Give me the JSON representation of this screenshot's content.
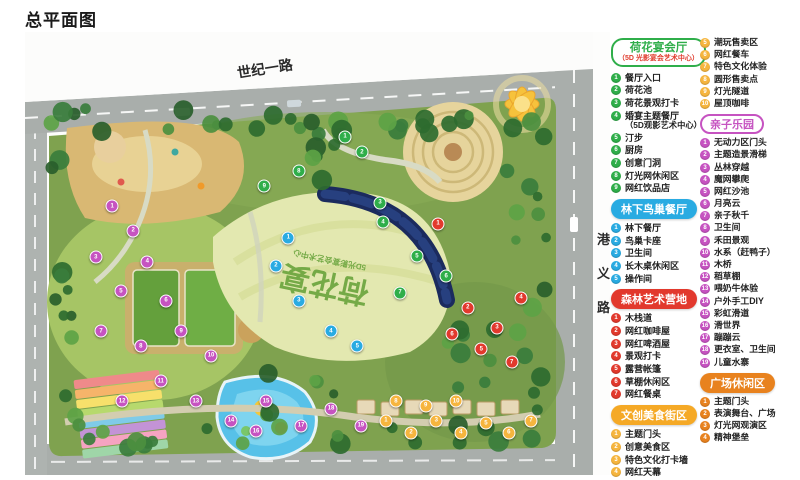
{
  "page": {
    "title": "总平面图"
  },
  "map": {
    "road_top_label": "世纪一路",
    "road_right_label": "港义路",
    "lawn_title": "荷花宴",
    "lawn_subtitle": "5D光影宴会艺术中心",
    "marker_colors": {
      "green": "#2fae4a",
      "blue": "#29abe2",
      "red": "#e2392d",
      "magenta": "#c653c1",
      "yellow": "#f6b53e"
    },
    "markers": [
      {
        "n": 1,
        "c": "green",
        "x": 54.7,
        "y": 23.7
      },
      {
        "n": 2,
        "c": "green",
        "x": 57.6,
        "y": 27.1
      },
      {
        "n": 3,
        "c": "green",
        "x": 60.7,
        "y": 38.6
      },
      {
        "n": 4,
        "c": "green",
        "x": 61.2,
        "y": 42.9
      },
      {
        "n": 5,
        "c": "green",
        "x": 67.0,
        "y": 50.6
      },
      {
        "n": 6,
        "c": "green",
        "x": 72.0,
        "y": 55.1
      },
      {
        "n": 7,
        "c": "green",
        "x": 64.1,
        "y": 58.9
      },
      {
        "n": 8,
        "c": "green",
        "x": 46.8,
        "y": 31.4
      },
      {
        "n": 9,
        "c": "green",
        "x": 40.9,
        "y": 34.8
      },
      {
        "n": 1,
        "c": "blue",
        "x": 45.0,
        "y": 46.5
      },
      {
        "n": 2,
        "c": "blue",
        "x": 42.9,
        "y": 52.8
      },
      {
        "n": 3,
        "c": "blue",
        "x": 46.8,
        "y": 60.7
      },
      {
        "n": 4,
        "c": "blue",
        "x": 52.3,
        "y": 67.5
      },
      {
        "n": 5,
        "c": "blue",
        "x": 56.8,
        "y": 70.9
      },
      {
        "n": 1,
        "c": "red",
        "x": 70.6,
        "y": 43.3
      },
      {
        "n": 2,
        "c": "red",
        "x": 75.7,
        "y": 62.3
      },
      {
        "n": 3,
        "c": "red",
        "x": 80.7,
        "y": 66.8
      },
      {
        "n": 4,
        "c": "red",
        "x": 84.8,
        "y": 60.0
      },
      {
        "n": 5,
        "c": "red",
        "x": 78.0,
        "y": 71.6
      },
      {
        "n": 6,
        "c": "red",
        "x": 73.0,
        "y": 68.2
      },
      {
        "n": 7,
        "c": "red",
        "x": 83.2,
        "y": 74.5
      },
      {
        "n": 1,
        "c": "magenta",
        "x": 14.9,
        "y": 39.3
      },
      {
        "n": 2,
        "c": "magenta",
        "x": 18.5,
        "y": 44.9
      },
      {
        "n": 3,
        "c": "magenta",
        "x": 12.1,
        "y": 50.8
      },
      {
        "n": 4,
        "c": "magenta",
        "x": 20.9,
        "y": 51.9
      },
      {
        "n": 5,
        "c": "magenta",
        "x": 16.4,
        "y": 58.5
      },
      {
        "n": 6,
        "c": "magenta",
        "x": 24.1,
        "y": 60.7
      },
      {
        "n": 7,
        "c": "magenta",
        "x": 13.0,
        "y": 67.5
      },
      {
        "n": 8,
        "c": "magenta",
        "x": 19.8,
        "y": 70.9
      },
      {
        "n": 9,
        "c": "magenta",
        "x": 26.7,
        "y": 67.5
      },
      {
        "n": 10,
        "c": "magenta",
        "x": 31.8,
        "y": 73.1
      },
      {
        "n": 11,
        "c": "magenta",
        "x": 23.2,
        "y": 78.8
      },
      {
        "n": 12,
        "c": "magenta",
        "x": 16.6,
        "y": 83.3
      },
      {
        "n": 13,
        "c": "magenta",
        "x": 29.2,
        "y": 83.3
      },
      {
        "n": 14,
        "c": "magenta",
        "x": 35.2,
        "y": 87.8
      },
      {
        "n": 15,
        "c": "magenta",
        "x": 41.2,
        "y": 83.3
      },
      {
        "n": 16,
        "c": "magenta",
        "x": 39.5,
        "y": 90.1
      },
      {
        "n": 17,
        "c": "magenta",
        "x": 47.2,
        "y": 88.9
      },
      {
        "n": 18,
        "c": "magenta",
        "x": 52.3,
        "y": 85.1
      },
      {
        "n": 19,
        "c": "magenta",
        "x": 57.4,
        "y": 88.9
      },
      {
        "n": 1,
        "c": "yellow",
        "x": 61.7,
        "y": 87.8
      },
      {
        "n": 2,
        "c": "yellow",
        "x": 66.0,
        "y": 90.5
      },
      {
        "n": 3,
        "c": "yellow",
        "x": 70.3,
        "y": 87.8
      },
      {
        "n": 4,
        "c": "yellow",
        "x": 74.5,
        "y": 90.5
      },
      {
        "n": 5,
        "c": "yellow",
        "x": 78.8,
        "y": 88.3
      },
      {
        "n": 6,
        "c": "yellow",
        "x": 82.7,
        "y": 90.5
      },
      {
        "n": 7,
        "c": "yellow",
        "x": 86.5,
        "y": 87.8
      },
      {
        "n": 8,
        "c": "yellow",
        "x": 63.4,
        "y": 83.3
      },
      {
        "n": 9,
        "c": "yellow",
        "x": 68.5,
        "y": 84.4
      },
      {
        "n": 10,
        "c": "yellow",
        "x": 73.7,
        "y": 83.3
      }
    ]
  },
  "legend": {
    "columns": [
      {
        "sections": [
          {
            "title": "荷花宴会厅",
            "subtitle": "（5D 光影宴会艺术中心）",
            "color": "#2fae4a",
            "style": "outline2",
            "start": 1,
            "items": [
              {
                "t": "餐厅入口"
              },
              {
                "t": "荷花池"
              },
              {
                "t": "荷花景观打卡"
              },
              {
                "t": "婚宴主题餐厅",
                "s": "（5D观影艺术中心）"
              },
              {
                "t": "汀步"
              },
              {
                "t": "厨房"
              },
              {
                "t": "创意门洞"
              },
              {
                "t": "灯光网休闲区"
              },
              {
                "t": "网红饮品店"
              }
            ]
          },
          {
            "title": "林下鸟巢餐厅",
            "color": "#29abe2",
            "style": "solid",
            "start": 1,
            "items": [
              {
                "t": "林下餐厅"
              },
              {
                "t": "鸟巢卡座"
              },
              {
                "t": "卫生间"
              },
              {
                "t": "长木桌休闲区"
              },
              {
                "t": "操作间"
              }
            ]
          },
          {
            "title": "森林艺术营地",
            "color": "#e2392d",
            "style": "solid",
            "start": 1,
            "items": [
              {
                "t": "木栈道"
              },
              {
                "t": "网红咖啡屋"
              },
              {
                "t": "网红啤酒屋"
              },
              {
                "t": "景观打卡"
              },
              {
                "t": "露营帐篷"
              },
              {
                "t": "草棚休闲区"
              },
              {
                "t": "网红餐桌"
              }
            ]
          },
          {
            "title": "文创美食街区",
            "color": "#f5a926",
            "badge_color": "#f6b53e",
            "style": "solid",
            "start": 1,
            "items": [
              {
                "t": "主题门头"
              },
              {
                "t": "创意美食区"
              },
              {
                "t": "特色文化打卡墙"
              },
              {
                "t": "网红天幕"
              }
            ]
          }
        ]
      },
      {
        "sections": [
          {
            "title": null,
            "color": "#f6b53e",
            "style": "none",
            "start": 5,
            "items": [
              {
                "t": "潮玩售卖区"
              },
              {
                "t": "网红餐车"
              },
              {
                "t": "特色文化体验"
              },
              {
                "t": "圆形售卖点"
              },
              {
                "t": "灯光隧道"
              },
              {
                "t": "屋顶咖啡"
              }
            ]
          },
          {
            "title": "亲子乐园",
            "color": "#c653c1",
            "style": "outline",
            "start": 1,
            "items": [
              {
                "t": "无动力区门头"
              },
              {
                "t": "主题造景滑梯"
              },
              {
                "t": "丛林穿越"
              },
              {
                "t": "魔网攀爬"
              },
              {
                "t": "网红沙池"
              },
              {
                "t": "月亮云"
              },
              {
                "t": "亲子秋千"
              },
              {
                "t": "卫生间"
              },
              {
                "t": "禾田景观"
              },
              {
                "t": "水系（赶鸭子）"
              },
              {
                "t": "木桥"
              },
              {
                "t": "稻草棚"
              },
              {
                "t": "喂奶牛体验"
              },
              {
                "t": "户外手工DIY"
              },
              {
                "t": "彩虹滑道"
              },
              {
                "t": "滑世界"
              },
              {
                "t": "蹦蹦云"
              },
              {
                "t": "更衣室、卫生间"
              },
              {
                "t": "儿童水寨"
              }
            ]
          },
          {
            "title": "广场休闲区",
            "color": "#e8821e",
            "style": "solid",
            "start": 1,
            "items": [
              {
                "t": "主题门头"
              },
              {
                "t": "表演舞台、广场"
              },
              {
                "t": "灯光网观演区"
              },
              {
                "t": "精神堡垒"
              }
            ]
          }
        ]
      }
    ]
  }
}
